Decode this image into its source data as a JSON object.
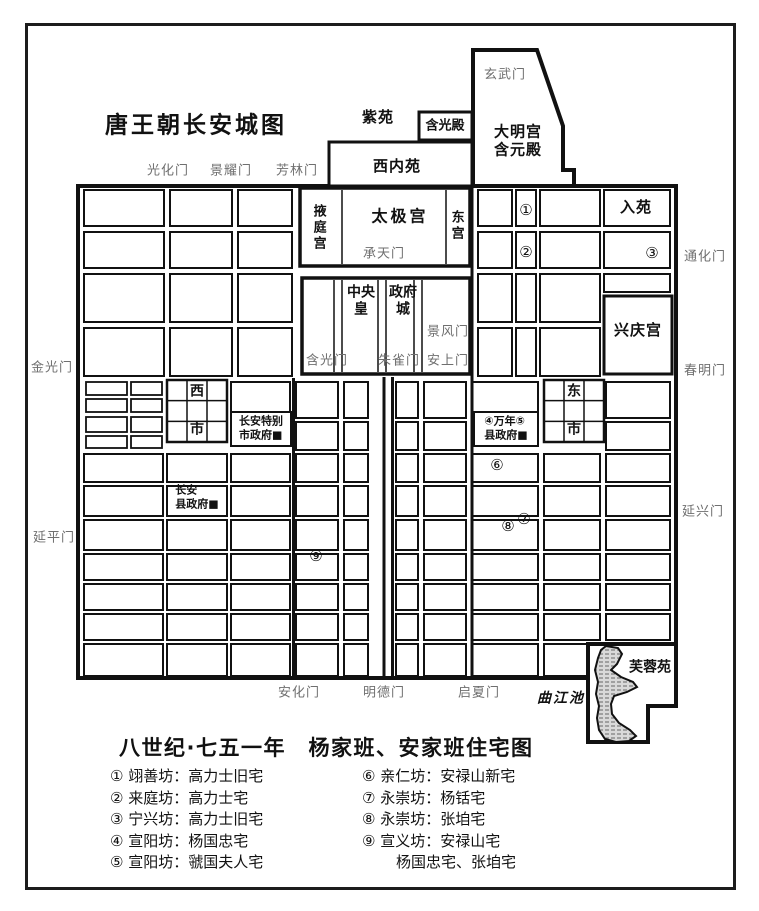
{
  "map": {
    "labels": [
      {
        "name": "map-title",
        "text": "唐王朝长安城图",
        "x": 196,
        "y": 126,
        "cls": "title"
      },
      {
        "name": "gate-xuanwu",
        "text": "玄武门",
        "x": 505,
        "y": 75,
        "cls": "gate"
      },
      {
        "name": "ziyuan-label",
        "text": "紫苑",
        "x": 378,
        "y": 118,
        "cls": "bold15"
      },
      {
        "name": "hanguang-hall-label",
        "text": "含光殿",
        "x": 445,
        "y": 126,
        "cls": "bold13"
      },
      {
        "name": "daming-palace-label",
        "text": "大明宫\n含元殿",
        "x": 518,
        "y": 141,
        "cls": "bold15 pre"
      },
      {
        "name": "west-inner-park-label",
        "text": "西内苑",
        "x": 397,
        "y": 167,
        "cls": "bold15"
      },
      {
        "name": "gate-guanghua",
        "text": "光化门",
        "x": 168,
        "y": 171,
        "cls": "gate"
      },
      {
        "name": "gate-jingyao",
        "text": "景耀门",
        "x": 231,
        "y": 171,
        "cls": "gate"
      },
      {
        "name": "gate-fanglin",
        "text": "芳林门",
        "x": 297,
        "y": 171,
        "cls": "gate"
      },
      {
        "name": "yeting-palace-label",
        "text": "掖庭宫",
        "x": 318,
        "y": 228,
        "cls": "bold13 vert"
      },
      {
        "name": "taiji-palace-label",
        "text": "太极宫",
        "x": 400,
        "y": 217,
        "cls": "bold16"
      },
      {
        "name": "east-palace-label",
        "text": "东宫",
        "x": 456,
        "y": 226,
        "cls": "bold13 vert"
      },
      {
        "name": "gate-chengtian",
        "text": "承天门",
        "x": 384,
        "y": 254,
        "cls": "gate"
      },
      {
        "name": "ruyuan-label",
        "text": "入苑",
        "x": 636,
        "y": 208,
        "cls": "bold15"
      },
      {
        "name": "marker-1",
        "text": "①",
        "x": 526,
        "y": 211,
        "cls": "circ"
      },
      {
        "name": "marker-2",
        "text": "②",
        "x": 526,
        "y": 253,
        "cls": "circ"
      },
      {
        "name": "marker-3",
        "text": "③",
        "x": 652,
        "y": 254,
        "cls": "circ"
      },
      {
        "name": "gate-tonghua",
        "text": "通化门",
        "x": 705,
        "y": 257,
        "cls": "gate"
      },
      {
        "name": "central-gov-label",
        "text": "中央\n皇",
        "x": 361,
        "y": 301,
        "cls": "bold14 pre"
      },
      {
        "name": "gov-city-label",
        "text": "政府\n城",
        "x": 403,
        "y": 301,
        "cls": "bold14 pre"
      },
      {
        "name": "gate-jingfeng",
        "text": "景风门",
        "x": 448,
        "y": 332,
        "cls": "gate"
      },
      {
        "name": "gate-hanguangmen",
        "text": "含光门",
        "x": 327,
        "y": 361,
        "cls": "gate"
      },
      {
        "name": "gate-zhuque",
        "text": "朱雀门",
        "x": 399,
        "y": 361,
        "cls": "gate"
      },
      {
        "name": "gate-anshang",
        "text": "安上门",
        "x": 448,
        "y": 361,
        "cls": "gate"
      },
      {
        "name": "xingqing-palace-label",
        "text": "兴庆宫",
        "x": 638,
        "y": 331,
        "cls": "bold15"
      },
      {
        "name": "gate-jinguang",
        "text": "金光门",
        "x": 52,
        "y": 368,
        "cls": "gate"
      },
      {
        "name": "gate-chunming",
        "text": "春明门",
        "x": 705,
        "y": 371,
        "cls": "gate"
      },
      {
        "name": "west-market-xi",
        "text": "西",
        "x": 197,
        "y": 392,
        "cls": "bold14"
      },
      {
        "name": "west-market-shi",
        "text": "市",
        "x": 197,
        "y": 430,
        "cls": "bold14"
      },
      {
        "name": "changan-special-gov-label",
        "text": "长安特别\n市政府■",
        "x": 261,
        "y": 428,
        "cls": "gov pre left"
      },
      {
        "name": "east-market-dong",
        "text": "东",
        "x": 574,
        "y": 392,
        "cls": "bold14"
      },
      {
        "name": "east-market-shi",
        "text": "市",
        "x": 574,
        "y": 430,
        "cls": "bold14"
      },
      {
        "name": "wannian-gov-label",
        "text": "④万年⑤\n县政府■",
        "x": 506,
        "y": 428,
        "cls": "gov pre left"
      },
      {
        "name": "marker-6",
        "text": "⑥",
        "x": 497,
        "y": 466,
        "cls": "circ"
      },
      {
        "name": "changan-gov-label",
        "text": "长安\n县政府■",
        "x": 197,
        "y": 497,
        "cls": "gov pre left"
      },
      {
        "name": "gate-yanxing",
        "text": "延兴门",
        "x": 703,
        "y": 512,
        "cls": "gate"
      },
      {
        "name": "marker-7",
        "text": "⑦",
        "x": 524,
        "y": 520,
        "cls": "circ"
      },
      {
        "name": "marker-8",
        "text": "⑧",
        "x": 508,
        "y": 527,
        "cls": "circ"
      },
      {
        "name": "gate-yanping",
        "text": "延平门",
        "x": 54,
        "y": 538,
        "cls": "gate"
      },
      {
        "name": "marker-9",
        "text": "⑨",
        "x": 316,
        "y": 557,
        "cls": "circ"
      },
      {
        "name": "gate-anhua",
        "text": "安化门",
        "x": 299,
        "y": 693,
        "cls": "gate"
      },
      {
        "name": "gate-mingde",
        "text": "明德门",
        "x": 384,
        "y": 693,
        "cls": "gate"
      },
      {
        "name": "gate-qixia",
        "text": "启夏门",
        "x": 479,
        "y": 693,
        "cls": "gate"
      },
      {
        "name": "qujiang-pond-label",
        "text": "曲江池",
        "x": 561,
        "y": 699,
        "cls": "bold14 italic"
      },
      {
        "name": "furong-garden-label",
        "text": "芙蓉苑",
        "x": 650,
        "y": 668,
        "cls": "bold14"
      }
    ]
  },
  "legend": {
    "title": "八世纪·七五一年　杨家班、安家班住宅图",
    "left": [
      "① 翊善坊：高力士旧宅",
      "② 来庭坊：高力士宅",
      "③ 宁兴坊：高力士旧宅",
      "④ 宣阳坊：杨国忠宅",
      "⑤ 宣阳坊：虢国夫人宅"
    ],
    "right": [
      "⑥ 亲仁坊：安禄山新宅",
      "⑦ 永崇坊：杨铦宅",
      "⑧ 永崇坊：张垍宅",
      "⑨ 宣义坊：安禄山宅",
      "杨国忠宅、张垍宅"
    ]
  }
}
